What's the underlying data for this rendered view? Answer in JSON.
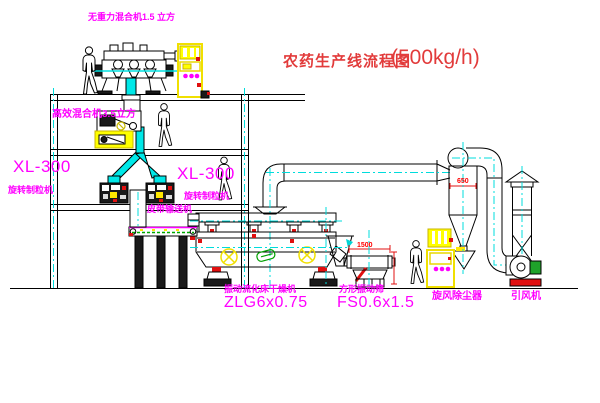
{
  "title": {
    "text": "农药生产线流程图",
    "capacity": "(500kg/h)"
  },
  "equipment_labels": {
    "gravity_free_mixer": "无重力混合机1.5 立方",
    "high_efficiency_mixer": "高效混合机3.5立方",
    "granulator_left_model": "XL-300",
    "granulator_left_name": "旋转制粒机",
    "granulator_right_model": "XL-300",
    "granulator_right_name": "旋转制粒机",
    "belt_conveyor": "皮带输送机",
    "fluid_bed_dryer_name": "振动流化床干燥机",
    "fluid_bed_dryer_model": "ZLG6x0.75",
    "square_vibrating_sieve_name": "方形振动筛",
    "square_vibrating_sieve_model": "FS0.6x1.5",
    "cyclone_dust_collector": "旋风除尘器",
    "induced_draft_fan": "引风机"
  },
  "dimensions": {
    "sieve_length": "1500",
    "cyclone_diameter": "650"
  },
  "colors": {
    "label": "#ff00ff",
    "title": "#e23b3b",
    "dimension": "#ff0000",
    "centerline": "#00dcdc",
    "highlight": "#ffff00"
  }
}
